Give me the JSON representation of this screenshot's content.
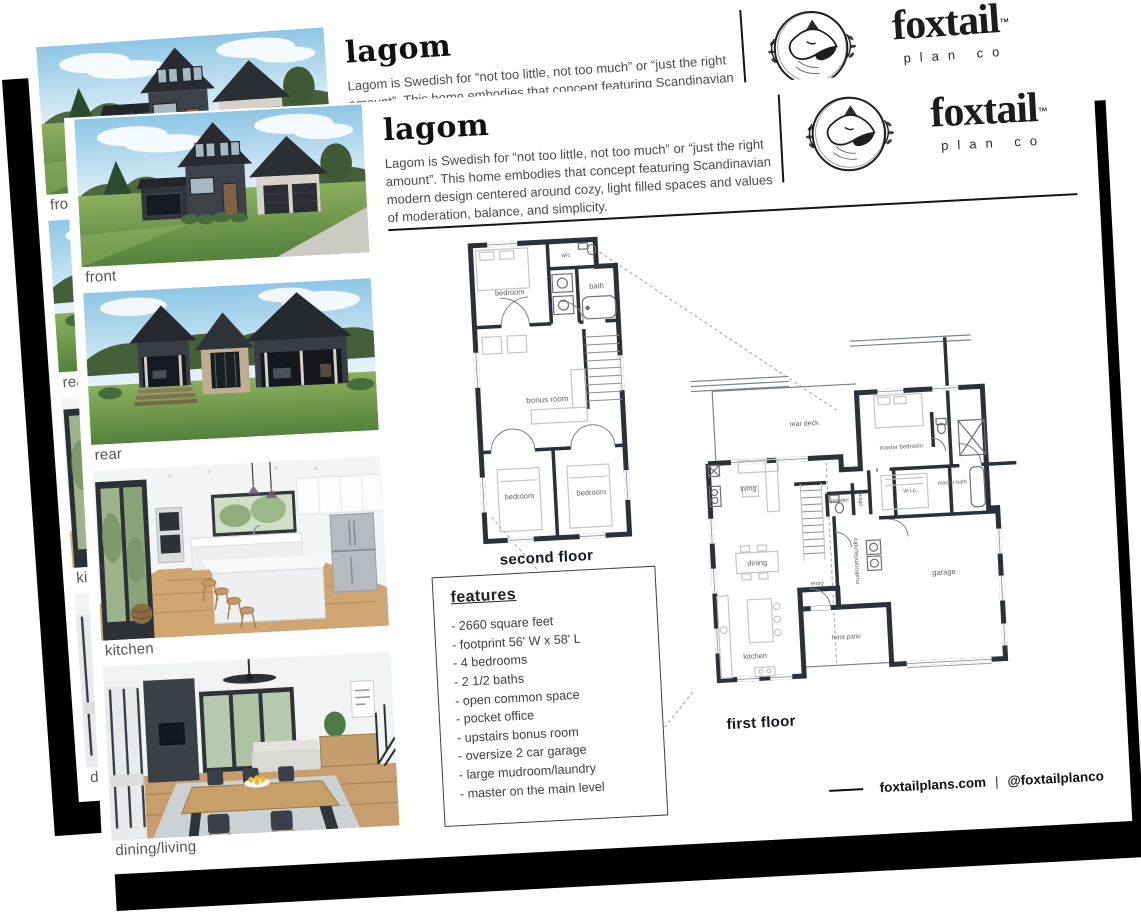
{
  "flyer": {
    "title": "lagom",
    "description": "Lagom is Swedish for “not too little, not too much” or “just the right amount”. This home embodies that concept featuring Scandinavian modern design centered around cozy, light filled spaces and values of moderation, balance, and simplicity.",
    "brand": {
      "wordmark": "foxtail",
      "trademark": "™",
      "tagline": "plan co"
    },
    "photos": {
      "front_label": "front",
      "rear_label": "rear",
      "kitchen_label": "kitchen",
      "dining_label": "dining/living"
    },
    "second_floor": {
      "caption": "second floor",
      "rooms": {
        "bedroom1": "bedroom",
        "wc": "w/c",
        "bath": "bath",
        "bonus": "bonus room",
        "bedroom2": "bedroom",
        "bedroom3": "bedroom"
      }
    },
    "first_floor": {
      "caption": "first floor",
      "rooms": {
        "rear_deck": "rear deck",
        "master_bedroom": "master bedroom",
        "master_bath": "master bath",
        "wic": "w.i.c.",
        "living": "living",
        "powder": "powder",
        "office": "office",
        "dining": "dining",
        "mudroom": "mudroom/laundry",
        "entry": "entry",
        "front_patio": "front patio",
        "kitchen": "kitchen",
        "garage": "garage"
      }
    },
    "features": {
      "heading": "features",
      "items": [
        "- 2660 square feet",
        "- footprint 56' W x 58' L",
        "- 4 bedrooms",
        "- 2 1/2 baths",
        "- open common space",
        "- pocket office",
        "- upstairs bonus room",
        "- oversize 2 car garage",
        "- large mudroom/laundry",
        "- master on the main level"
      ]
    },
    "footer": {
      "website": "foxtailplans.com",
      "divider": "|",
      "handle": "@foxtailplanco"
    },
    "colors": {
      "paper": "#ffffff",
      "ink": "#151515",
      "shadow": "#000000",
      "plan_wall": "#2a3139"
    }
  }
}
